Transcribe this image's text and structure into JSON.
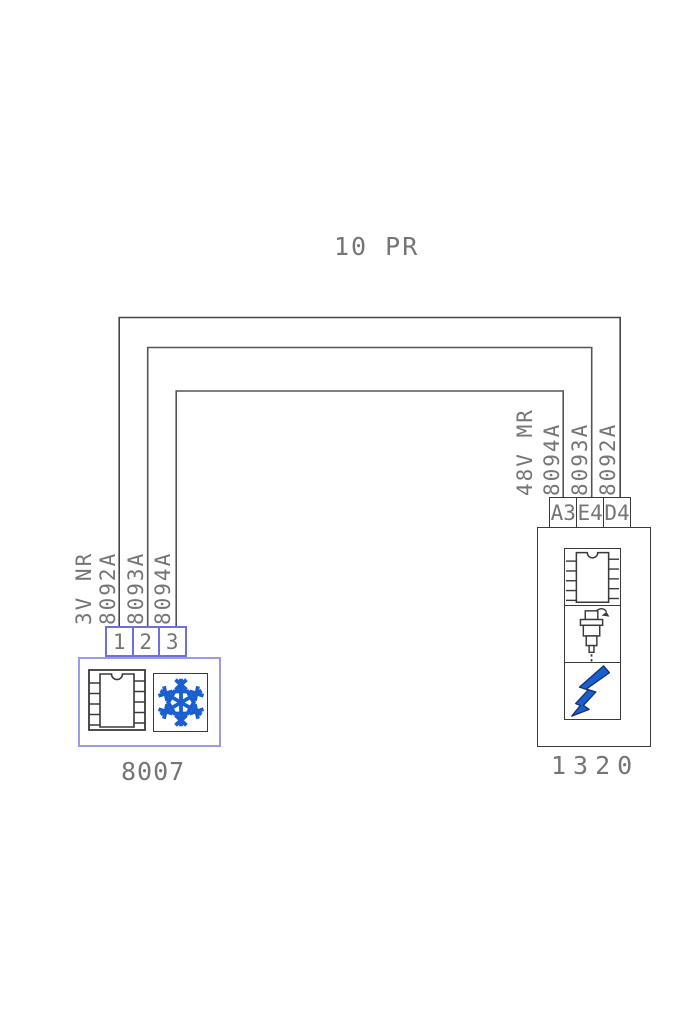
{
  "page": {
    "bundle_label": "10 PR"
  },
  "left_component": {
    "code": "8007",
    "harness_label": "3V NR",
    "wire_labels": [
      "8092A",
      "8093A",
      "8094A"
    ],
    "pins": [
      "1",
      "2",
      "3"
    ],
    "icons": [
      "ic-chip-icon",
      "snowflake-icon"
    ]
  },
  "right_component": {
    "code": "1320",
    "harness_label": "48V MR",
    "wire_labels": [
      "8094A",
      "8093A",
      "8092A"
    ],
    "pins": [
      "A3",
      "E4",
      "D4"
    ],
    "icons": [
      "ic-chip-icon",
      "fuel-injector-icon",
      "lightning-bolt-icon"
    ]
  },
  "wires": [
    {
      "label": "8092A",
      "from_component": "8007",
      "from_pin": "1",
      "to_component": "1320",
      "to_pin": "D4"
    },
    {
      "label": "8093A",
      "from_component": "8007",
      "from_pin": "2",
      "to_component": "1320",
      "to_pin": "E4"
    },
    {
      "label": "8094A",
      "from_component": "8007",
      "from_pin": "3",
      "to_component": "1320",
      "to_pin": "A3"
    }
  ],
  "colors": {
    "wire": "#454545",
    "text_gray": "#757575",
    "left_box_border": "#9a9ae8",
    "left_pin_border": "#6f6fe0",
    "dark_border": "#3a3a3a",
    "icon_blue": "#1a5fd0"
  }
}
